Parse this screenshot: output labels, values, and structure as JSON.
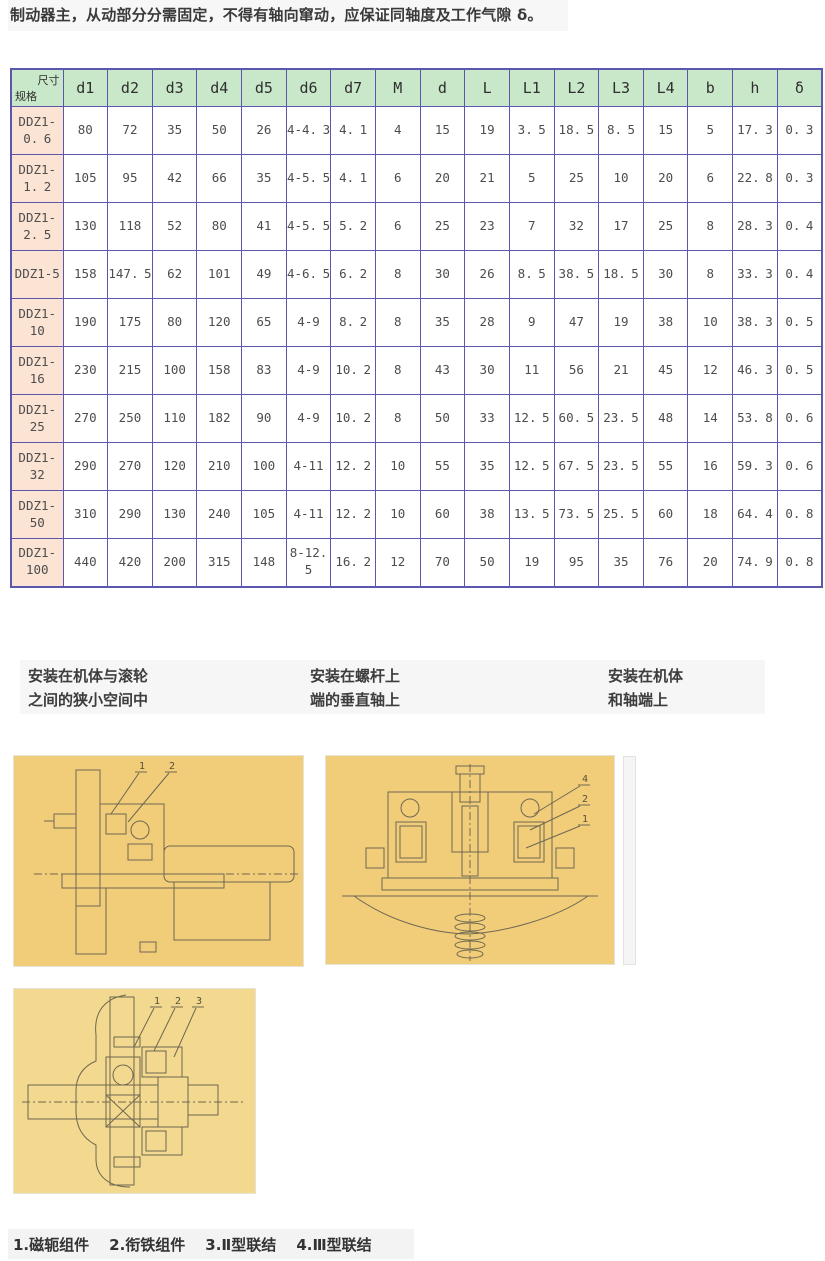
{
  "intro_text": "制动器主，从动部分分需固定，不得有轴向窜动，应保证同轴度及工作气隙 δ。",
  "spec_table": {
    "corner": {
      "top_right": "尺寸",
      "bottom_left": "规格"
    },
    "columns": [
      "d1",
      "d2",
      "d3",
      "d4",
      "d5",
      "d6",
      "d7",
      "M",
      "d",
      "L",
      "L1",
      "L2",
      "L3",
      "L4",
      "b",
      "h",
      "δ"
    ],
    "rows": [
      {
        "spec": "DDZ1-0. 6",
        "values": [
          "80",
          "72",
          "35",
          "50",
          "26",
          "4-4. 3",
          "4. 1",
          "4",
          "15",
          "19",
          "3. 5",
          "18. 5",
          "8. 5",
          "15",
          "5",
          "17. 3",
          "0. 3"
        ]
      },
      {
        "spec": "DDZ1-1. 2",
        "values": [
          "105",
          "95",
          "42",
          "66",
          "35",
          "4-5. 5",
          "4. 1",
          "6",
          "20",
          "21",
          "5",
          "25",
          "10",
          "20",
          "6",
          "22. 8",
          "0. 3"
        ]
      },
      {
        "spec": "DDZ1-2. 5",
        "values": [
          "130",
          "118",
          "52",
          "80",
          "41",
          "4-5. 5",
          "5. 2",
          "6",
          "25",
          "23",
          "7",
          "32",
          "17",
          "25",
          "8",
          "28. 3",
          "0. 4"
        ]
      },
      {
        "spec": "DDZ1-5",
        "values": [
          "158",
          "147. 5",
          "62",
          "101",
          "49",
          "4-6. 5",
          "6. 2",
          "8",
          "30",
          "26",
          "8. 5",
          "38. 5",
          "18. 5",
          "30",
          "8",
          "33. 3",
          "0. 4"
        ]
      },
      {
        "spec": "DDZ1-10",
        "values": [
          "190",
          "175",
          "80",
          "120",
          "65",
          "4-9",
          "8. 2",
          "8",
          "35",
          "28",
          "9",
          "47",
          "19",
          "38",
          "10",
          "38. 3",
          "0. 5"
        ]
      },
      {
        "spec": "DDZ1-16",
        "values": [
          "230",
          "215",
          "100",
          "158",
          "83",
          "4-9",
          "10. 2",
          "8",
          "43",
          "30",
          "11",
          "56",
          "21",
          "45",
          "12",
          "46. 3",
          "0. 5"
        ]
      },
      {
        "spec": "DDZ1-25",
        "values": [
          "270",
          "250",
          "110",
          "182",
          "90",
          "4-9",
          "10. 2",
          "8",
          "50",
          "33",
          "12. 5",
          "60. 5",
          "23. 5",
          "48",
          "14",
          "53. 8",
          "0. 6"
        ]
      },
      {
        "spec": "DDZ1-32",
        "values": [
          "290",
          "270",
          "120",
          "210",
          "100",
          "4-11",
          "12. 2",
          "10",
          "55",
          "35",
          "12. 5",
          "67. 5",
          "23. 5",
          "55",
          "16",
          "59. 3",
          "0. 6"
        ]
      },
      {
        "spec": "DDZ1-50",
        "values": [
          "310",
          "290",
          "130",
          "240",
          "105",
          "4-11",
          "12. 2",
          "10",
          "60",
          "38",
          "13. 5",
          "73. 5",
          "25. 5",
          "60",
          "18",
          "64. 4",
          "0. 8"
        ]
      },
      {
        "spec": "DDZ1-100",
        "values": [
          "440",
          "420",
          "200",
          "315",
          "148",
          "8-12. 5",
          "16. 2",
          "12",
          "70",
          "50",
          "19",
          "95",
          "35",
          "76",
          "20",
          "74. 9",
          "0. 8"
        ]
      }
    ],
    "colors": {
      "header_bg": "#c9e7c9",
      "spec_bg": "#fce4d4",
      "border": "#5a57ad"
    }
  },
  "captions": [
    {
      "line1": "安装在机体与滚轮",
      "line2": "之间的狭小空间中"
    },
    {
      "line1": "安装在螺杆上",
      "line2": "端的垂直轴上"
    },
    {
      "line1": "安装在机体",
      "line2": "和轴端上"
    }
  ],
  "figures": [
    {
      "name": "brake-in-narrow-space",
      "bg": "#f1cd7a",
      "callouts": [
        "1",
        "2"
      ]
    },
    {
      "name": "brake-on-vertical-screw-shaft",
      "bg": "#f1cd7a",
      "callouts": [
        "4",
        "2",
        "1"
      ]
    },
    {
      "name": "brake-on-body-and-shaft-end",
      "bg": "#f3d88f",
      "callouts": [
        "1",
        "2",
        "3"
      ]
    }
  ],
  "legend": {
    "items": [
      "1.磁轭组件",
      "2.衔铁组件",
      "3.Ⅱ型联结",
      "4.Ⅲ型联结"
    ]
  }
}
